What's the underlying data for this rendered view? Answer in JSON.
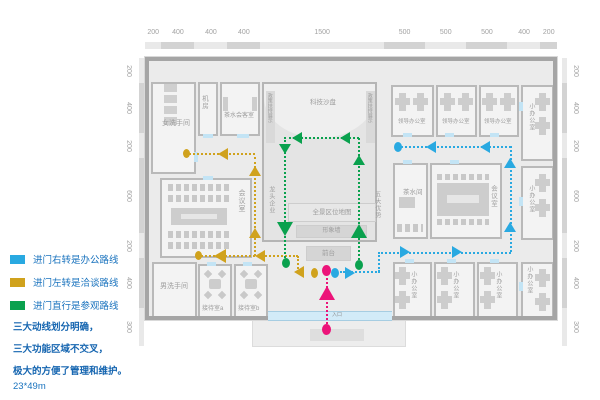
{
  "legend": {
    "items": [
      {
        "color": "#29a9e1",
        "label": "进门右转是办公路线"
      },
      {
        "color": "#d0a21d",
        "label": "进门左转是洽谈路线"
      },
      {
        "color": "#0aa14e",
        "label": "进门直行是参观路线"
      }
    ],
    "notes": [
      "三大动线划分明确，",
      "三大功能区域不交叉，",
      "极大的方便了管理和维护。"
    ],
    "size_note": "23*49m"
  },
  "dimensions": {
    "top": [
      "200",
      "400",
      "400",
      "400",
      "1500",
      "500",
      "500",
      "500",
      "400",
      "200"
    ],
    "left": [
      "200",
      "400",
      "200",
      "600",
      "200",
      "400",
      "300"
    ],
    "right": [
      "200",
      "400",
      "200",
      "600",
      "200",
      "400",
      "300"
    ]
  },
  "rooms": {
    "women_restroom": "女洗手间",
    "machine_room": "机房",
    "tea_reception_room": "茶水会客室",
    "tech_sandtable": "科技沙盘",
    "policy_display": "政策扶持展示",
    "leading_enterprise_wall": "龙头企业",
    "five_advantages_wall": "五大优势",
    "panorama_location_map": "全景区位地图",
    "image_wall": "形象墙",
    "front_desk": "前台",
    "meeting_room": "会议室",
    "tea_room": "茶水间",
    "leader_office": "领导办公室",
    "small_office": "小办公室",
    "men_restroom": "男洗手间",
    "reception_room_a": "接待室a",
    "reception_room_b": "接待室b",
    "entrance": "入口"
  },
  "routes": {
    "office": {
      "name": "办公路线",
      "color": "#29a9e1"
    },
    "negotiation": {
      "name": "洽谈路线",
      "color": "#d0a21d"
    },
    "visit": {
      "name": "参观路线",
      "color": "#0aa14e"
    },
    "entry": {
      "name": "入口",
      "color": "#ec1379"
    }
  }
}
